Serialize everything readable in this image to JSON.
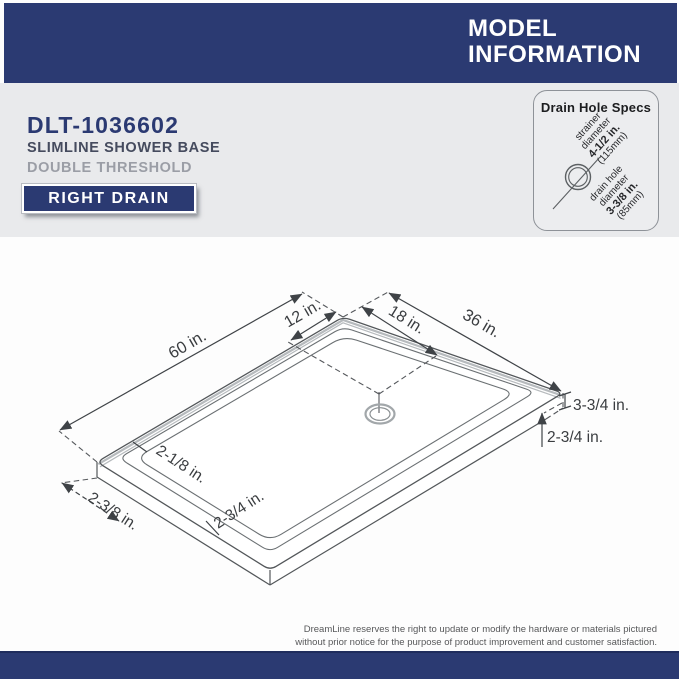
{
  "header": {
    "model_info_line1": "MODEL",
    "model_info_line2": "INFORMATION"
  },
  "product": {
    "model_number": "DLT-1036602",
    "name": "SLIMLINE SHOWER BASE",
    "threshold": "DOUBLE THRESHOLD",
    "drain_badge": "RIGHT DRAIN"
  },
  "drain_specs": {
    "title": "Drain Hole Specs",
    "strainer": {
      "l1": "strainer",
      "l2": "diameter",
      "l3": "4-1/2 in.",
      "l4": "(115mm)"
    },
    "drain_hole": {
      "l1": "drain hole",
      "l2": "diameter",
      "l3": "3-3/8 in.",
      "l4": "(85mm)"
    }
  },
  "diagram": {
    "dims": {
      "length": "60 in.",
      "drain_offset_left": "12 in.",
      "drain_offset_right": "18 in.",
      "width": "36 in.",
      "height_outer": "3-3/4 in.",
      "height_step": "2-3/4 in.",
      "ledge_left": "2-1/8 in.",
      "ledge_bottom": "2-3/4 in.",
      "threshold_bottom": "2-3/8 in."
    }
  },
  "footer": {
    "disclaimer_line1": "DreamLine reserves the right to update or modify the hardware or materials pictured",
    "disclaimer_line2": "without prior notice for the purpose of product improvement and customer satisfaction."
  },
  "colors": {
    "navy": "#2b3a72",
    "page_gray": "#e9eaec",
    "line_dark": "#3f4347",
    "flange_gray": "#b6babd"
  }
}
